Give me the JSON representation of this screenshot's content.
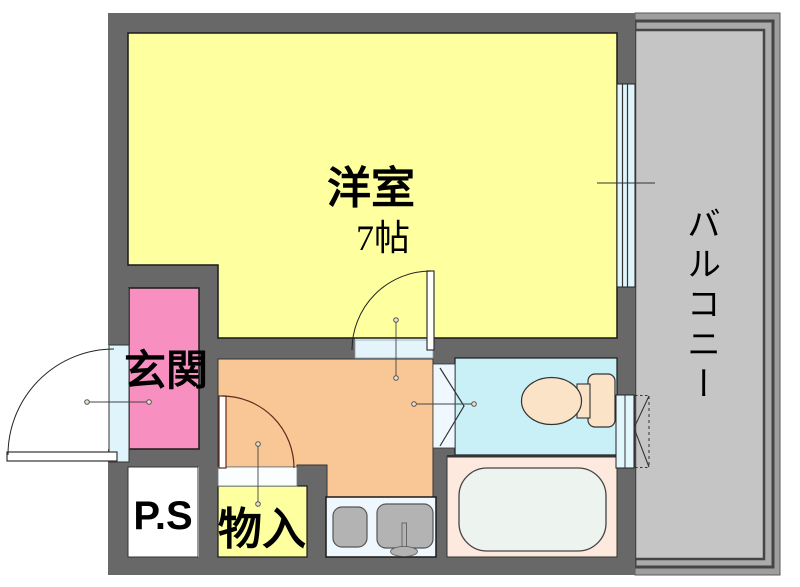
{
  "rooms": {
    "western": {
      "label": "洋室",
      "size": "7帖",
      "color": "#feff9e"
    },
    "entrance": {
      "label": "玄関",
      "color": "#f78fc0"
    },
    "pipe_space": {
      "label": "P.S",
      "color": "#ffffff"
    },
    "storage": {
      "label": "物入",
      "color": "#feff9e"
    },
    "kitchen": {
      "color": "#f8c795"
    },
    "washroom": {
      "color": "#c9eff7"
    },
    "bathroom": {
      "color": "#fde9dd"
    },
    "balcony": {
      "label": "バルコニー",
      "floor_color": "#c5c5c5"
    }
  },
  "walls": {
    "color": "#686868"
  },
  "windows": {
    "color": "#dff5fb"
  },
  "fixtures": {
    "icons": [
      "toilet-icon",
      "bathtub-icon",
      "kitchen-sink-icon",
      "stove-icon",
      "door-swing-arc"
    ],
    "toilet_color": "#fae3c6",
    "bathtub_color": "#edf3ee",
    "sink_color": "#b3b3b3"
  }
}
